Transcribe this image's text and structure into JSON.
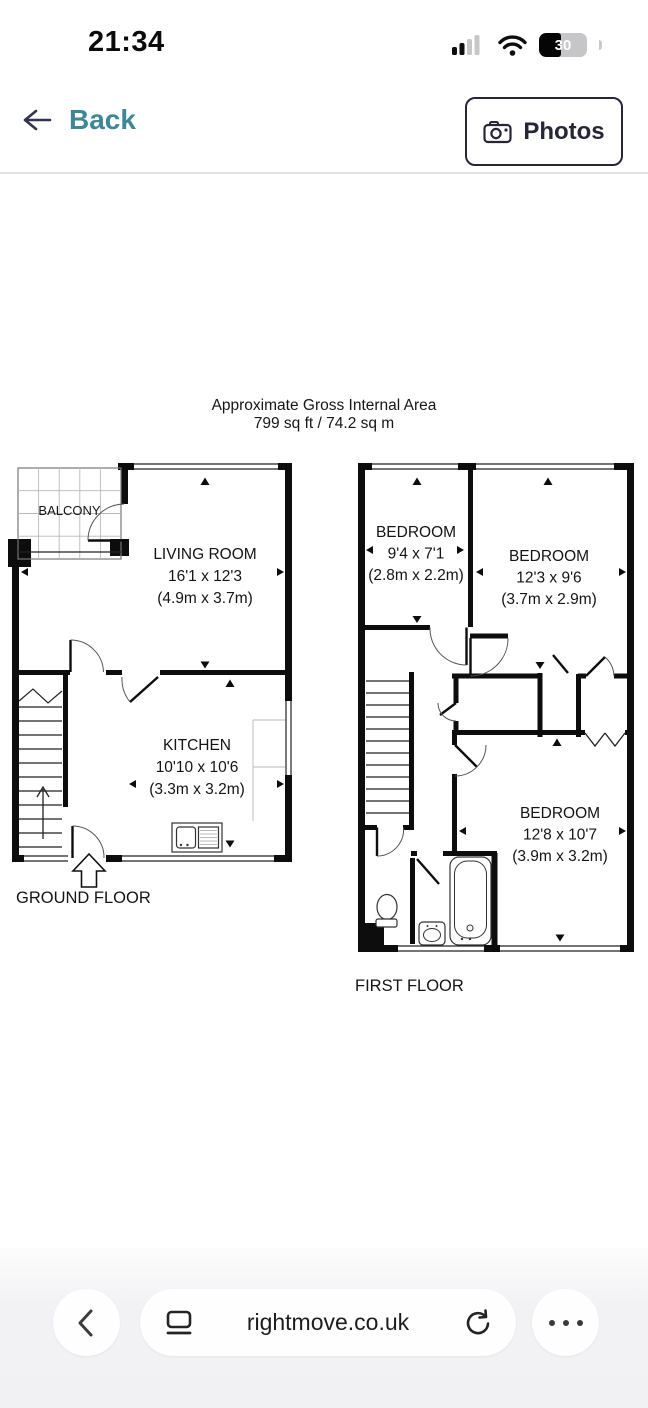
{
  "status_bar": {
    "time": "21:34",
    "battery_level": "30"
  },
  "nav": {
    "back_label": "Back",
    "photos_label": "Photos"
  },
  "floorplan": {
    "title_line1": "Approximate Gross Internal Area",
    "title_line2": "799 sq ft / 74.2 sq m",
    "balcony_label": "BALCONY",
    "ground_floor_label": "GROUND FLOOR",
    "first_floor_label": "FIRST FLOOR",
    "rooms": {
      "living_room": {
        "name": "LIVING ROOM",
        "imperial": "16'1 x 12'3",
        "metric": "(4.9m x 3.7m)"
      },
      "kitchen": {
        "name": "KITCHEN",
        "imperial": "10'10 x 10'6",
        "metric": "(3.3m x 3.2m)"
      },
      "bedroom_small": {
        "name": "BEDROOM",
        "imperial": "9'4 x 7'1",
        "metric": "(2.8m x 2.2m)"
      },
      "bedroom_right": {
        "name": "BEDROOM",
        "imperial": "12'3 x 9'6",
        "metric": "(3.7m x 2.9m)"
      },
      "bedroom_large": {
        "name": "BEDROOM",
        "imperial": "12'8 x 10'7",
        "metric": "(3.9m x 3.2m)"
      }
    }
  },
  "browser_bar": {
    "url": "rightmove.co.uk"
  },
  "colors": {
    "accent_teal": "#3e8796",
    "navy": "#262637"
  }
}
